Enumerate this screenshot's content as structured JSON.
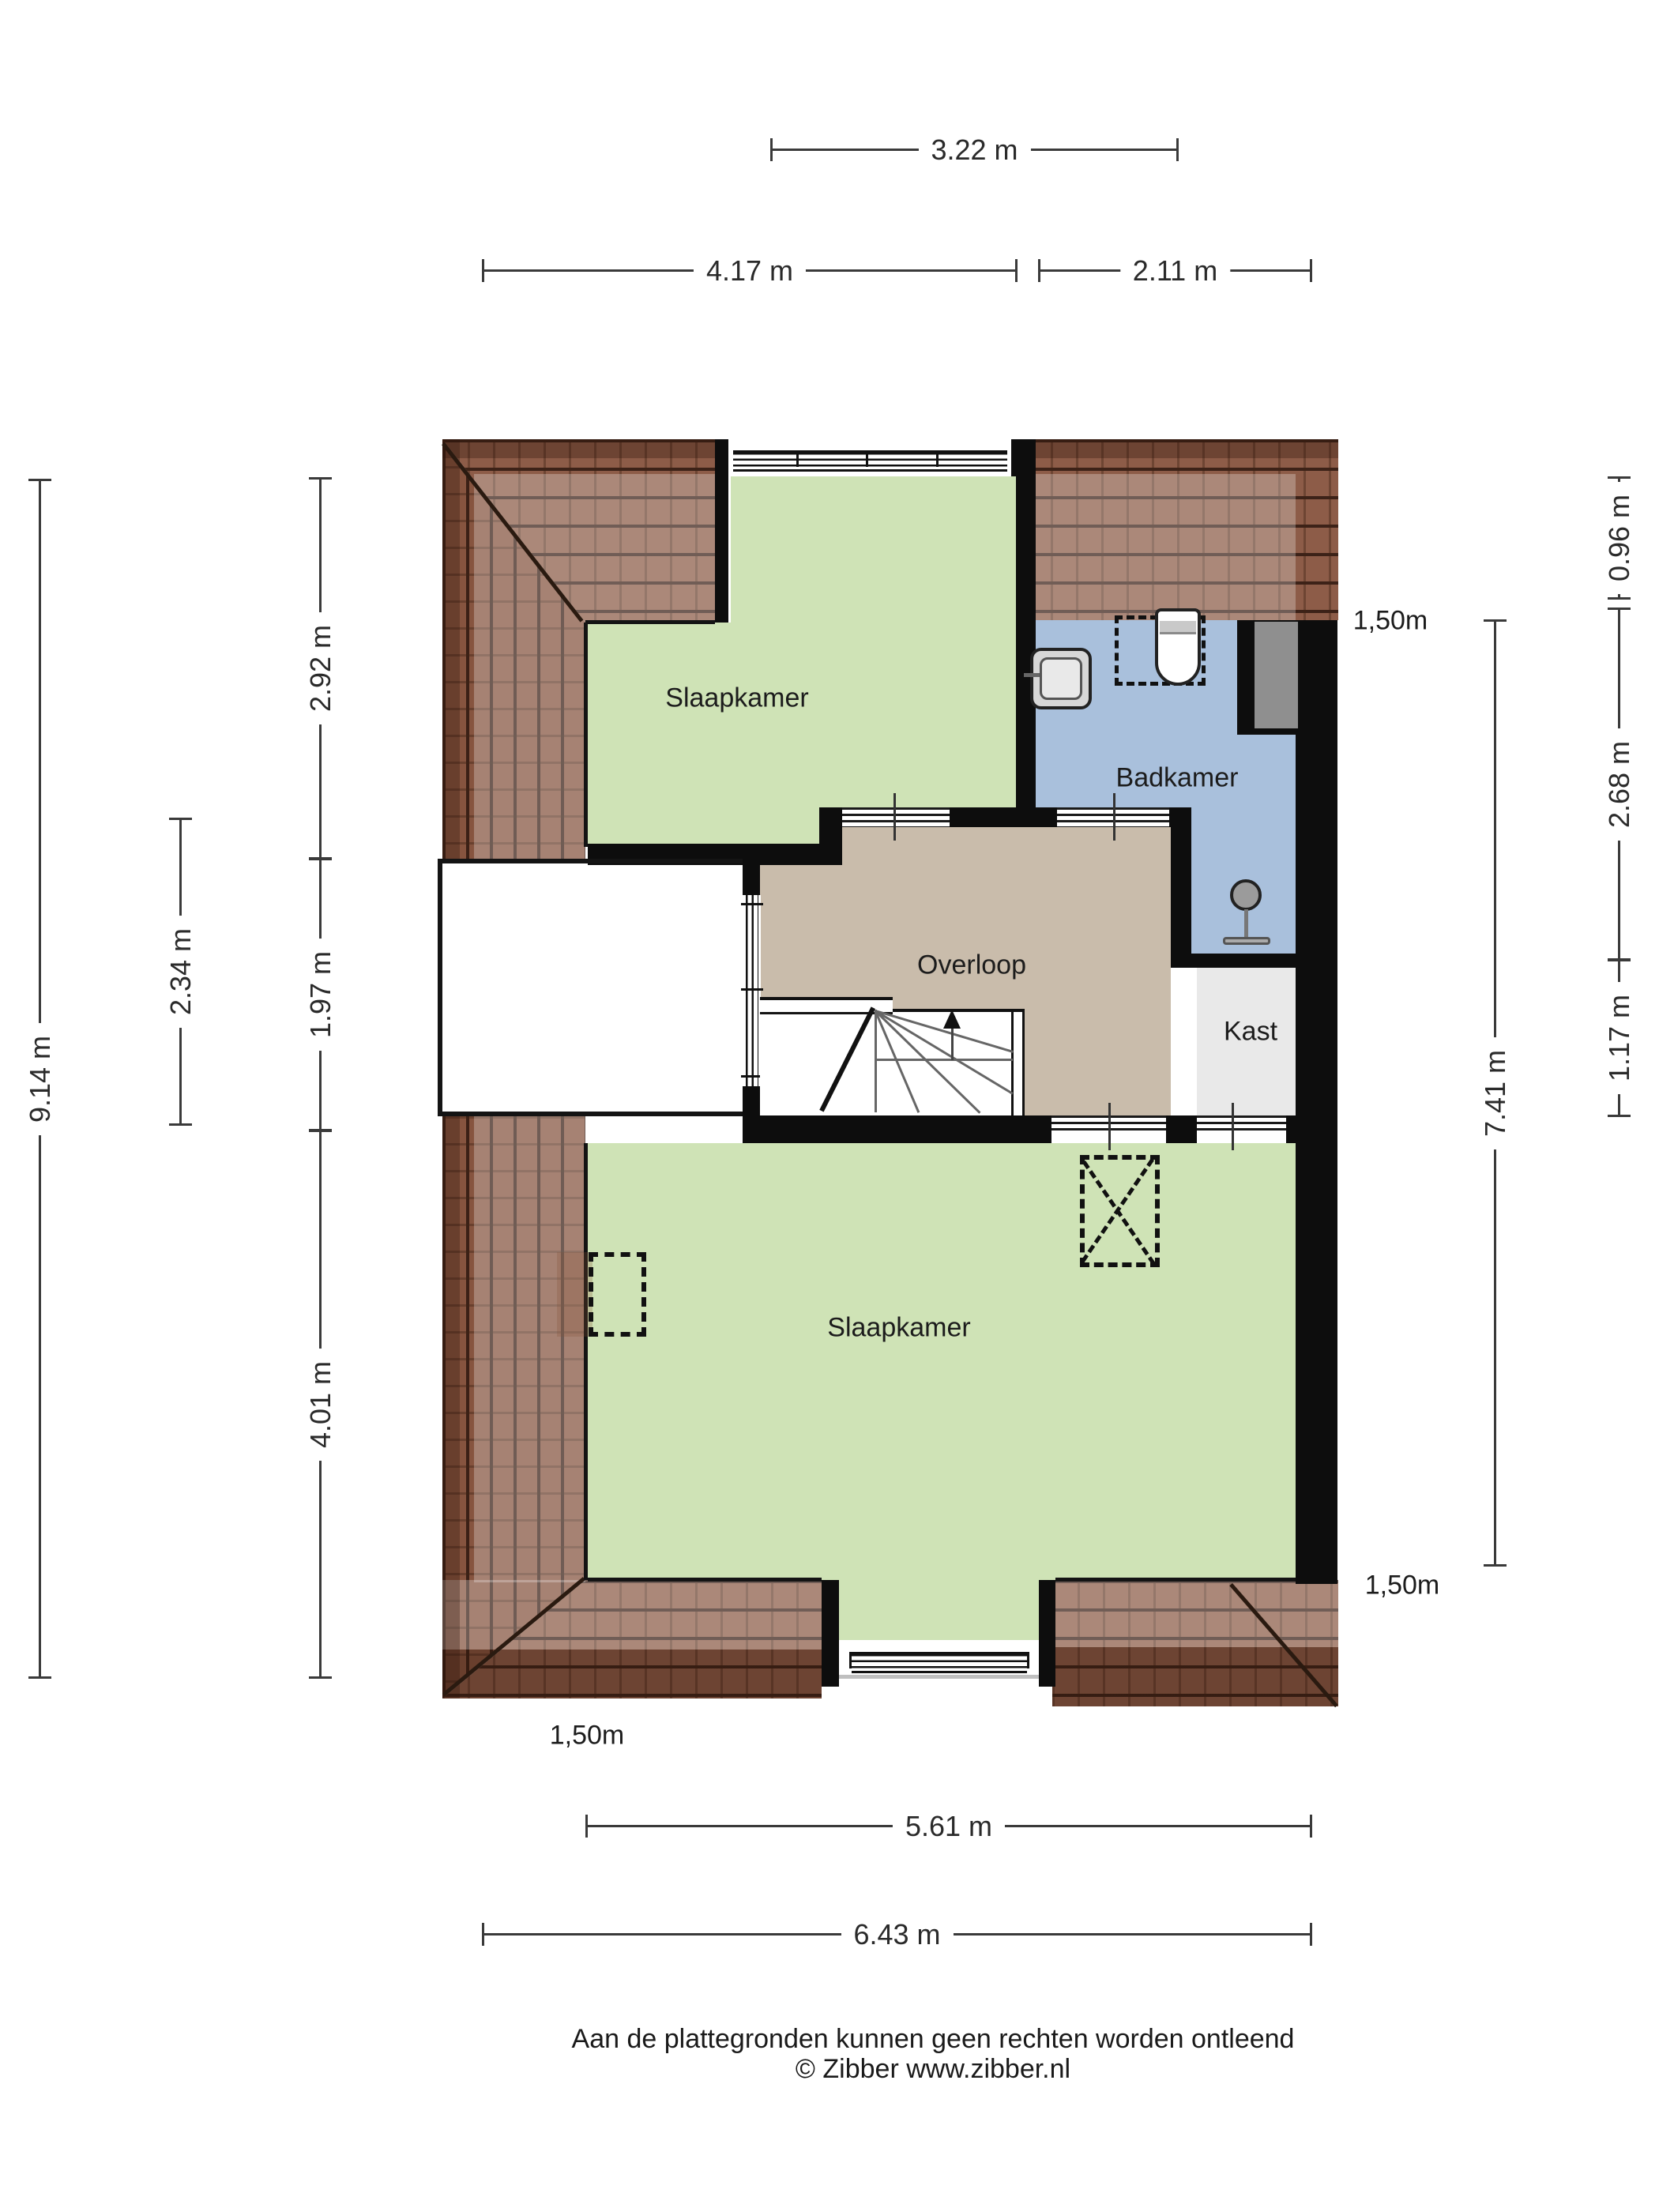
{
  "plan": {
    "type": "floorplan",
    "rooms": [
      {
        "id": "slaapkamer-top",
        "label": "Slaapkamer"
      },
      {
        "id": "badkamer",
        "label": "Badkamer"
      },
      {
        "id": "overloop",
        "label": "Overloop"
      },
      {
        "id": "kast",
        "label": "Kast"
      },
      {
        "id": "slaapkamer-bottom",
        "label": "Slaapkamer"
      }
    ],
    "fixtures": [
      "toilet",
      "sink",
      "shower",
      "stairs-up",
      "duct"
    ],
    "clearance_labels": [
      {
        "id": "top-right",
        "text": "1,50m"
      },
      {
        "id": "bottom-right",
        "text": "1,50m"
      },
      {
        "id": "bottom-left",
        "text": "1,50m"
      }
    ],
    "dimensions": {
      "top": [
        {
          "id": "dim-3-22",
          "label": "3.22 m"
        },
        {
          "id": "dim-4-17",
          "label": "4.17 m"
        },
        {
          "id": "dim-2-11",
          "label": "2.11 m"
        }
      ],
      "left_outer": {
        "label": "9.14 m"
      },
      "left_mid": {
        "label": "2.34 m"
      },
      "left_inner": [
        {
          "label": "2.92 m"
        },
        {
          "label": "1.97 m"
        },
        {
          "label": "4.01 m"
        }
      ],
      "right_inner": {
        "label": "7.41 m"
      },
      "right_outer": [
        {
          "label": "0.96 m"
        },
        {
          "label": "2.68 m"
        },
        {
          "label": "1.17 m"
        }
      ],
      "bottom": [
        {
          "label": "5.61 m"
        },
        {
          "label": "6.43 m"
        }
      ]
    },
    "footer": {
      "disclaimer": "Aan de plattegronden kunnen geen rechten worden ontleend",
      "credit": "© Zibber www.zibber.nl"
    },
    "colors": {
      "bedroom_green": "#cfe3b6",
      "bathroom_blue": "#a9c0dc",
      "landing_tan": "#c9bcab",
      "closet_gray": "#e9e9e9",
      "roof_brown": "#8d5c48",
      "wall_black": "#0d0d0d"
    }
  }
}
